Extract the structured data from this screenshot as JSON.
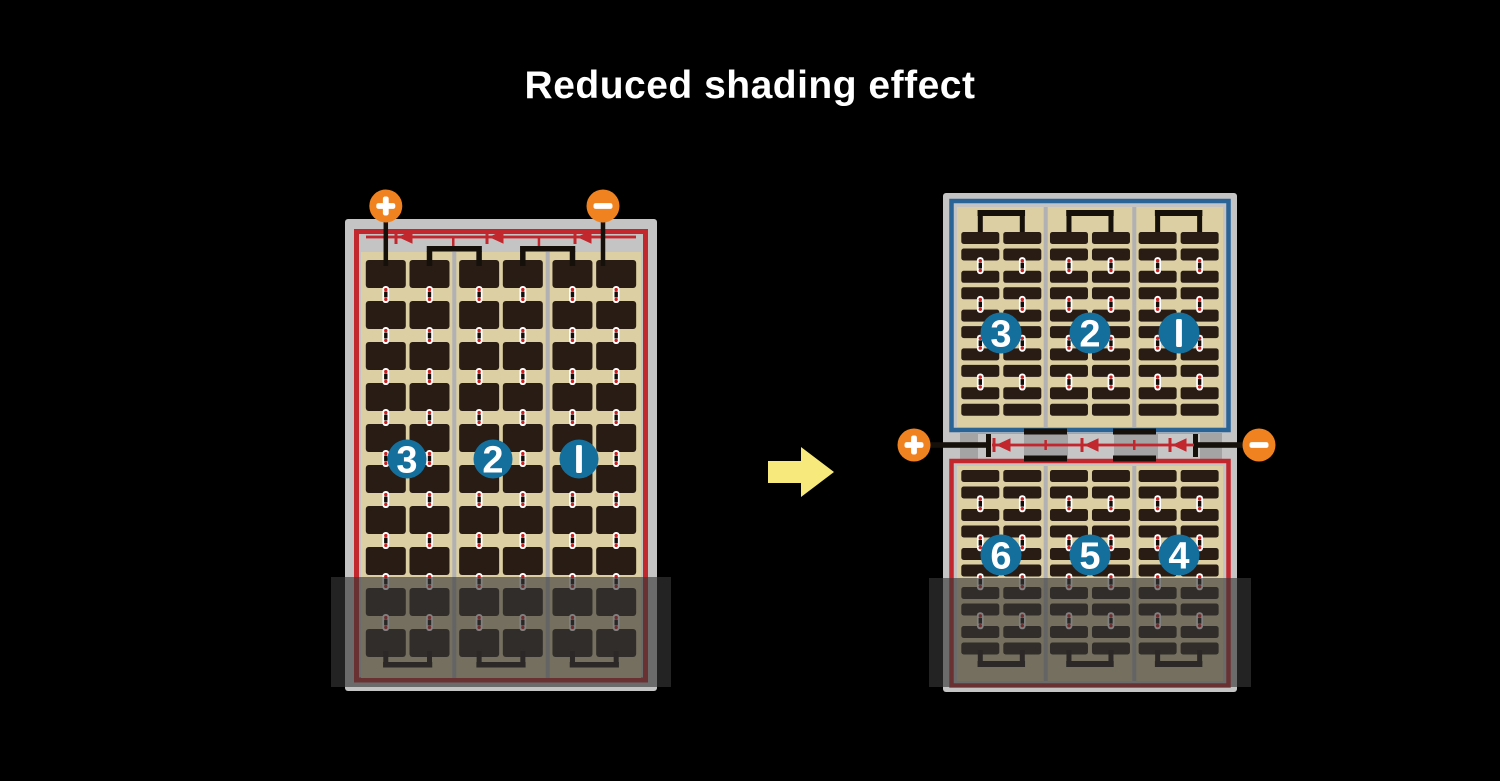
{
  "title": "Reduced shading effect",
  "colors": {
    "background": "#000000",
    "panel_frame": "#c5c4c5",
    "cell_field": "#dbcfa3",
    "cell": "#281c14",
    "string_separator": "#b1b0b2",
    "border_red": "#c1272d",
    "border_blue": "#2a6396",
    "number_circle": "#156f9d",
    "number_text": "#ffffff",
    "terminal_orange": "#f0831f",
    "terminal_text": "#ffffff",
    "wire_black": "#16100b",
    "diode_red": "#c1272d",
    "arrow_yellow": "#f7e97c",
    "shade_overlay": "rgba(56,56,56,0.63)",
    "junction_band": "#a5a4a5",
    "junction_block": "#c7c6c7",
    "connector_white": "#ffffff",
    "connector_dot": "#cc2020",
    "connector_bar": "#120d09"
  },
  "left_module": {
    "terminal_plus": "+",
    "terminal_minus": "−",
    "string_numbers": [
      "3",
      "2",
      "1"
    ]
  },
  "right_module": {
    "terminal_plus": "+",
    "terminal_minus": "−",
    "top_string_numbers": [
      "3",
      "2",
      "1"
    ],
    "bottom_string_numbers": [
      "6",
      "5",
      "4"
    ]
  }
}
